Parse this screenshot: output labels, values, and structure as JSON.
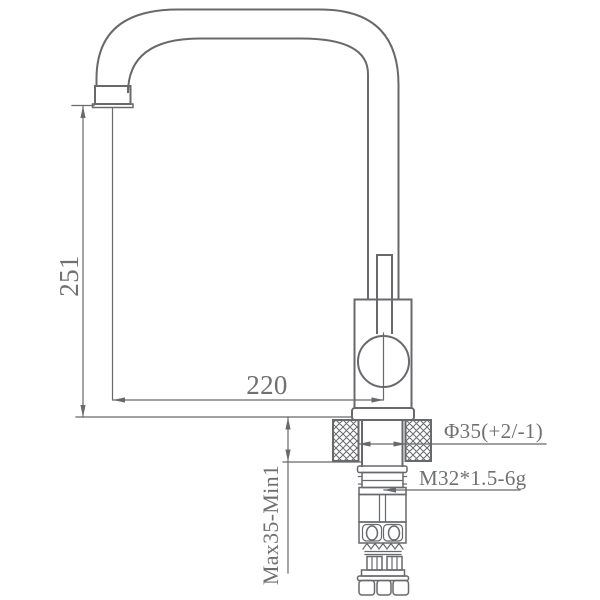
{
  "labels": {
    "spout_height": "251",
    "spout_reach": "220",
    "mounting_thickness": "Max35-Min1",
    "hole_diameter": "Φ35(+2/-1)",
    "thread_spec": "M32*1.5-6g"
  },
  "colors": {
    "line": "#68696c",
    "text": "#6f7073",
    "background": "#ffffff"
  }
}
